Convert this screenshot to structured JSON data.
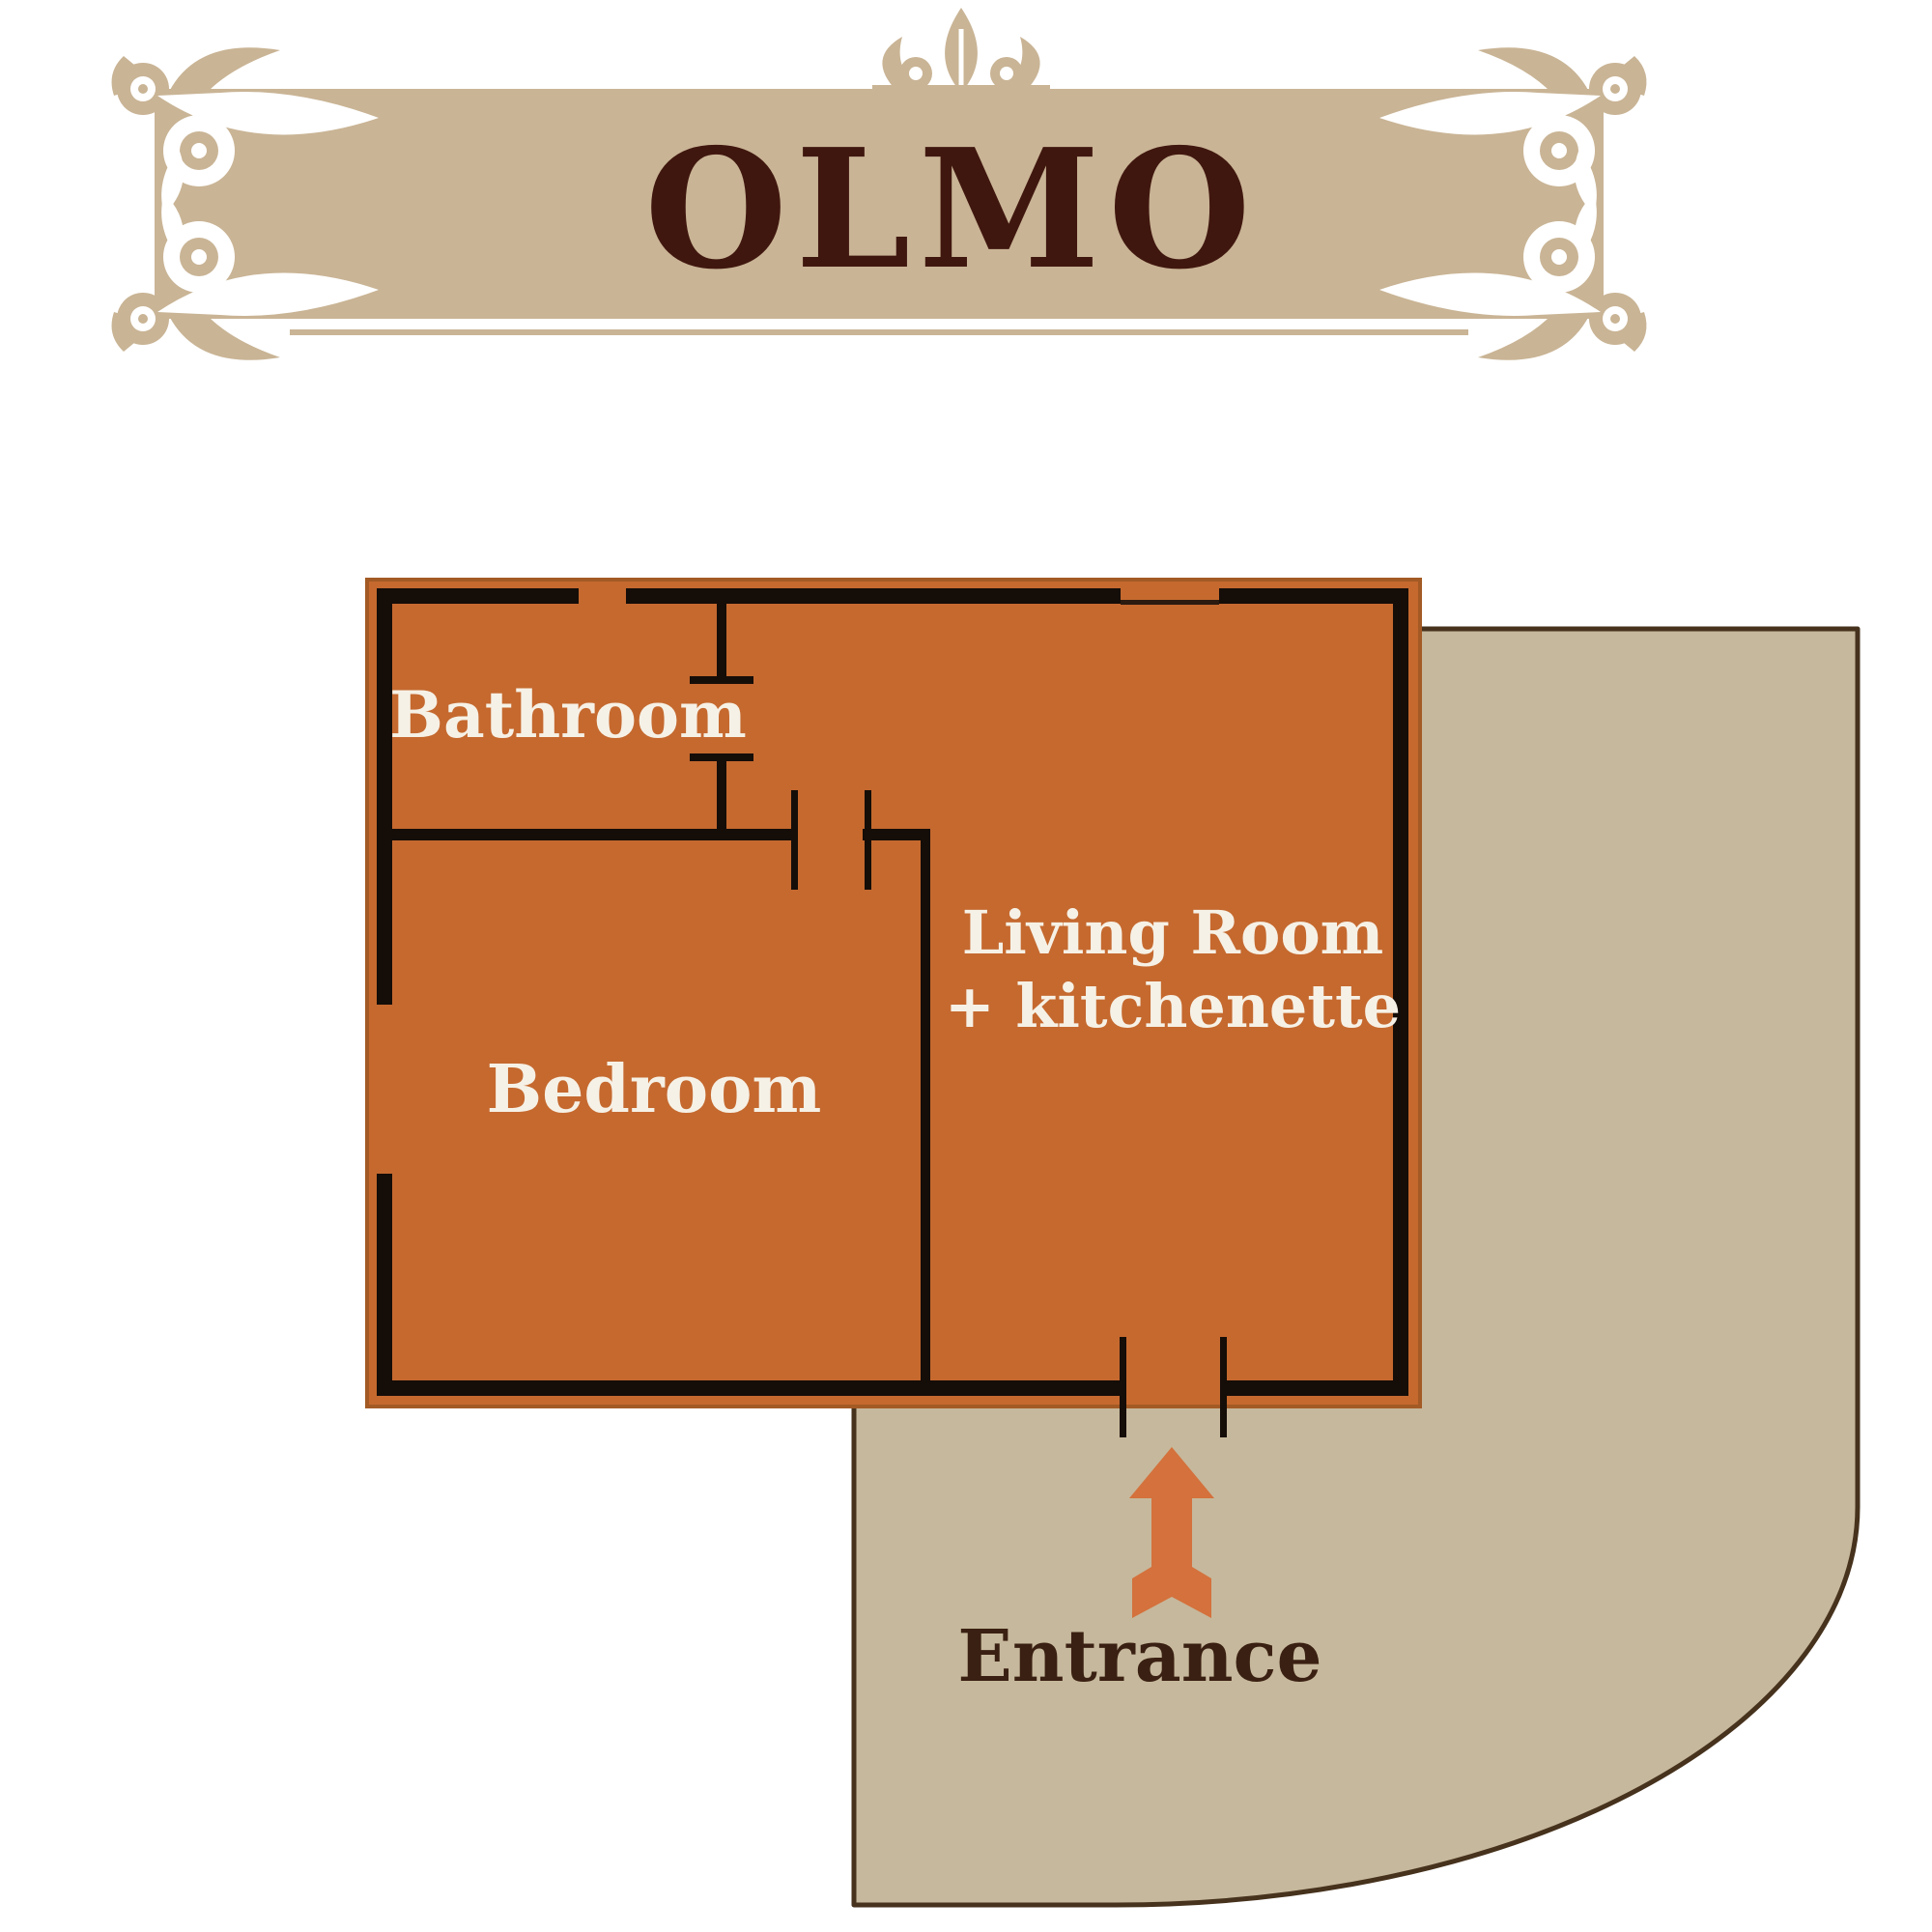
{
  "banner": {
    "title": "OLMO",
    "ornaments": [
      "corner-scroll-flourish-top-left",
      "corner-scroll-flourish-top-right",
      "corner-scroll-flourish-bottom-left",
      "corner-scroll-flourish-bottom-right",
      "fleur-de-lis-top-center"
    ]
  },
  "floor_plan": {
    "rooms": [
      {
        "label": "Bathroom"
      },
      {
        "label": "Bedroom"
      },
      {
        "label_line1": "Living Room",
        "label_line2": "+ kitchenette"
      }
    ],
    "entrance_label": "Entrance",
    "features": [
      "entrance-arrow-icon",
      "door-openings",
      "window-gaps",
      "terrace"
    ]
  },
  "colors": {
    "room_fill": "#c5692f",
    "room_edge": "#a35a24",
    "wall": "#150d08",
    "terrace_fill": "#c6b89c",
    "terrace_border": "#46321d",
    "banner_fill": "#c9b495",
    "title_text": "#40170f",
    "room_label_text": "#f6f1e6",
    "entrance_text": "#3a2012",
    "arrow": "#d4713c",
    "background": "#ffffff"
  }
}
